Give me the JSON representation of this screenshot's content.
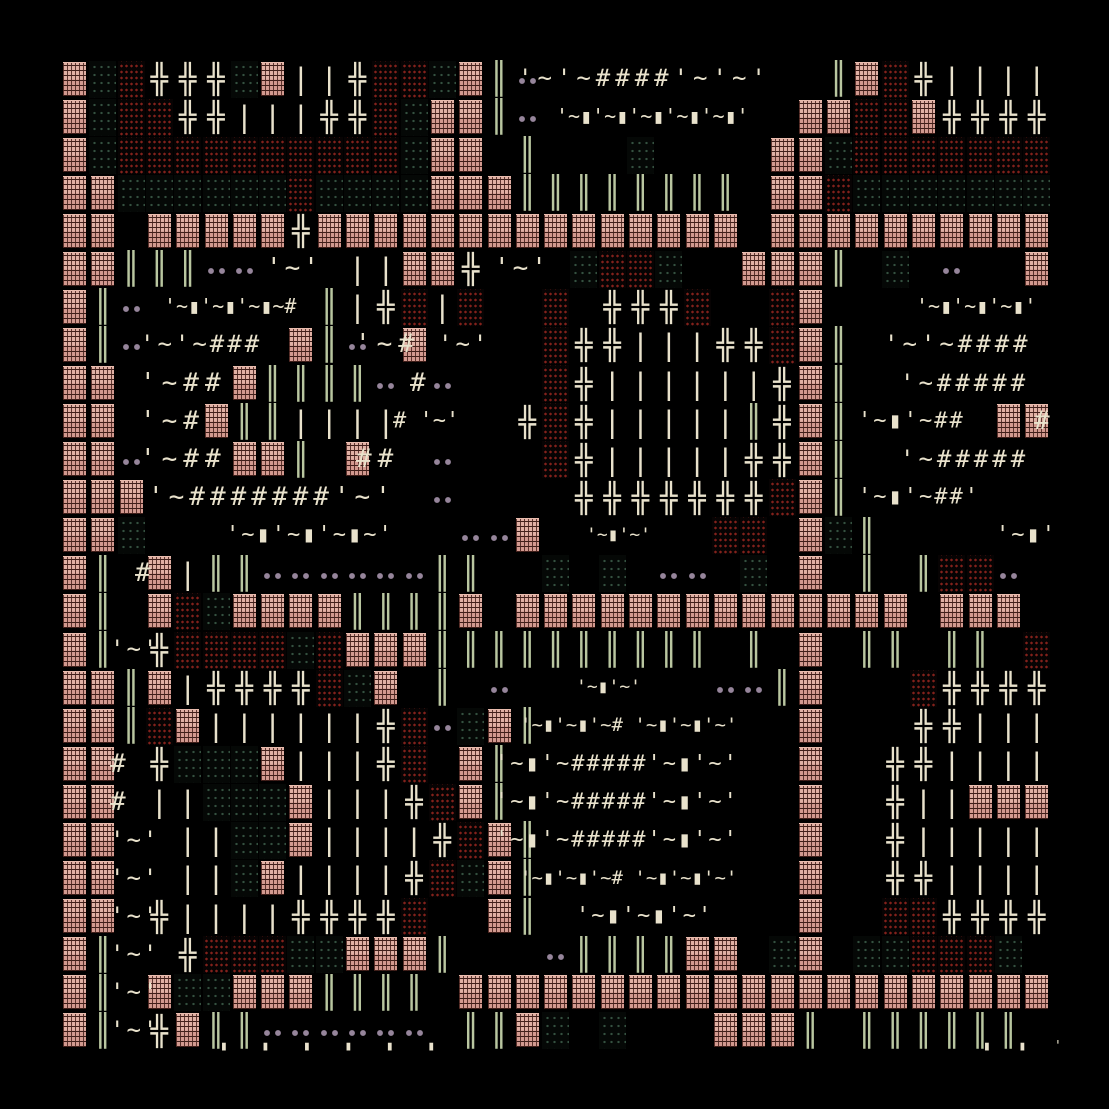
{
  "artwork": {
    "description": "generative ascii texture artwork on black background",
    "background": "#000000",
    "palette": {
      "cream_glyph": "#e9e2cc",
      "sage_double_bar": "#b9c6a0",
      "pink_block": "#d7a399",
      "pink_block_dark_seam": "#46201b",
      "pink_block_light_edge": "#e9bcae",
      "red_dot_block": "#83211b",
      "green_dot_block": "#355140",
      "mauve_dot": "#96859b"
    },
    "layout": {
      "art_x": 60,
      "art_y": 60,
      "cols": 35,
      "rows": 26,
      "cell_w": 28.3,
      "cell_h": 38.07
    }
  },
  "legend": {
    "P": {
      "name": "pink-woven-block",
      "type": "block",
      "cls": "bP"
    },
    "R": {
      "name": "red-dot-block",
      "type": "block",
      "cls": "bR"
    },
    "G": {
      "name": "green-dot-block",
      "type": "block",
      "cls": "bG"
    },
    ".": {
      "name": "mauve-dot-pair",
      "type": "block",
      "cls": "bD"
    },
    "+": {
      "name": "cross-glyph",
      "type": "glyph",
      "cls": "tC",
      "char": "╬"
    },
    "#": {
      "name": "hash-glyph",
      "type": "glyph",
      "cls": "tC",
      "char": "#"
    },
    "|": {
      "name": "bar-glyph",
      "type": "glyph",
      "cls": "tC",
      "char": "|"
    },
    "I": {
      "name": "double-bar-glyph",
      "type": "glyph",
      "cls": "tG",
      "char": "║"
    },
    "'": {
      "name": "apostrophe-glyph",
      "type": "glyph",
      "cls": "tC",
      "char": "'"
    },
    "~": {
      "name": "tilde-glyph",
      "type": "glyph",
      "cls": "tC",
      "char": "~"
    }
  },
  "grid": [
    "PGR+++GP||+RRGPI.          IPR+||||",
    "PGRR++|||++RGPPI.         PPRRP++++",
    "PGRRRRRRRRRRGPP I   G    PPGRRRRRRR",
    "PPGGGGGGRGGGGPPPIIIIIIII PPRGGGGGGG",
    "PP PPPPP+PPPPPPPPPPPPPPP PPPPPPPPPP",
    "PPIII..   ||PP+   GRRG  PPPI G .  P",
    "PI.      I|+R|R  R +++R  RP        ",
    "PI.     PI. P    R++|||++RPI       ",
    "PP    PIIII. .   R+||||||+PI       ",
    "PP   PII||||    +R+|||||I+PI     PP",
    "PP.   PPI P  .   R+|||||++PI       ",
    "PPP          .    +++++++RPI       ",
    "PPG           ..P      RR PGI      ",
    "PI P|II......II  G G .. G P I IRR. ",
    "PI PRGPPPPIIIIP PPPPPPPPPPPPPP PPP ",
    "PI +RRRRGRPPPIIIIIIIIII I P II II R",
    "PPIP|++++RGP I .       ..IP   R++++",
    "PPIRP||||||+R.GPI         P   ++|||",
    "PP +GGGP|||+R PI          P  ++||||",
    "PP ||GGGP|||+RPI          P  +||PPP",
    "PP  ||GGP||||+RPI         P  +|||||",
    "PP  ||GP||||+RGPI         P  ++||||",
    "PP +||||++++R  PI         P  RR++++",
    "PI  +RRRGGPPPI   .IIIIPP GP GGRRRG ",
    "PI PGGPPPIIII PPPPPPPPPPPPPPPPPPPPP",
    "PI +PII...... IIPG G   PPPI IIIIII "
  ],
  "texts": [
    {
      "x": 518,
      "y": 79,
      "s": 24,
      "ls": 5,
      "t": "'~'~####'~'~'"
    },
    {
      "x": 556,
      "y": 117,
      "s": 20,
      "ls": 0,
      "t": "'~▮'~▮'~▮'~▮'~▮'"
    },
    {
      "x": 266,
      "y": 269,
      "s": 26,
      "ls": 3,
      "t": "'~'"
    },
    {
      "x": 494,
      "y": 269,
      "s": 26,
      "ls": 3,
      "t": "'~'"
    },
    {
      "x": 164,
      "y": 307,
      "s": 20,
      "ls": 0,
      "t": "'~▮'~▮'~▮~#"
    },
    {
      "x": 916,
      "y": 307,
      "s": 20,
      "ls": 0,
      "t": "'~▮'~▮'~▮'"
    },
    {
      "x": 140,
      "y": 345,
      "s": 24,
      "ls": 3,
      "t": "'~'~###"
    },
    {
      "x": 355,
      "y": 345,
      "s": 26,
      "ls": 6,
      "t": "'~#"
    },
    {
      "x": 438,
      "y": 345,
      "s": 24,
      "ls": 3,
      "t": "'~'"
    },
    {
      "x": 884,
      "y": 345,
      "s": 24,
      "ls": 4,
      "t": "'~'~####"
    },
    {
      "x": 140,
      "y": 384,
      "s": 26,
      "ls": 6,
      "t": "'~##"
    },
    {
      "x": 410,
      "y": 384,
      "s": 26,
      "ls": 0,
      "t": "#"
    },
    {
      "x": 900,
      "y": 384,
      "s": 24,
      "ls": 4,
      "t": "'~#####"
    },
    {
      "x": 140,
      "y": 422,
      "s": 26,
      "ls": 6,
      "t": "'~#"
    },
    {
      "x": 393,
      "y": 422,
      "s": 22,
      "ls": 0,
      "t": "# '~'"
    },
    {
      "x": 858,
      "y": 422,
      "s": 22,
      "ls": 2,
      "t": "'~▮'~##"
    },
    {
      "x": 1034,
      "y": 422,
      "s": 26,
      "ls": 0,
      "t": "#"
    },
    {
      "x": 140,
      "y": 460,
      "s": 26,
      "ls": 6,
      "t": "'~##"
    },
    {
      "x": 356,
      "y": 460,
      "s": 26,
      "ls": 6,
      "t": "##"
    },
    {
      "x": 900,
      "y": 460,
      "s": 24,
      "ls": 4,
      "t": "'~#####"
    },
    {
      "x": 148,
      "y": 498,
      "s": 26,
      "ls": 5,
      "t": "'~#######'~'"
    },
    {
      "x": 858,
      "y": 498,
      "s": 22,
      "ls": 2,
      "t": "'~▮'~##'"
    },
    {
      "x": 226,
      "y": 536,
      "s": 22,
      "ls": 2,
      "t": "'~▮'~▮'~▮~'"
    },
    {
      "x": 586,
      "y": 536,
      "s": 18,
      "ls": 0,
      "t": "'~▮'~'"
    },
    {
      "x": 996,
      "y": 536,
      "s": 22,
      "ls": 2,
      "t": "'~▮'"
    },
    {
      "x": 135,
      "y": 574,
      "s": 26,
      "ls": 0,
      "t": "#"
    },
    {
      "x": 110,
      "y": 650,
      "s": 24,
      "ls": 2,
      "t": "'~'"
    },
    {
      "x": 576,
      "y": 688,
      "s": 18,
      "ls": 0,
      "t": "'~▮'~'"
    },
    {
      "x": 520,
      "y": 726,
      "s": 19,
      "ls": 0,
      "t": "'~▮'~▮'~# '~▮'~▮'~'"
    },
    {
      "x": 110,
      "y": 765,
      "s": 26,
      "ls": 0,
      "t": "#"
    },
    {
      "x": 495,
      "y": 765,
      "s": 22,
      "ls": 2,
      "t": "'~▮'~#####'~▮'~'"
    },
    {
      "x": 110,
      "y": 803,
      "s": 26,
      "ls": 0,
      "t": "#"
    },
    {
      "x": 495,
      "y": 803,
      "s": 22,
      "ls": 2,
      "t": "'~▮'~#####'~▮'~'"
    },
    {
      "x": 110,
      "y": 841,
      "s": 24,
      "ls": 2,
      "t": "'~'"
    },
    {
      "x": 495,
      "y": 841,
      "s": 22,
      "ls": 2,
      "t": "'~▮'~#####'~▮'~'"
    },
    {
      "x": 110,
      "y": 879,
      "s": 24,
      "ls": 2,
      "t": "'~'"
    },
    {
      "x": 520,
      "y": 879,
      "s": 19,
      "ls": 0,
      "t": "'~▮'~▮'~# '~▮'~▮'~'"
    },
    {
      "x": 110,
      "y": 917,
      "s": 24,
      "ls": 2,
      "t": "'~'"
    },
    {
      "x": 576,
      "y": 917,
      "s": 22,
      "ls": 2,
      "t": "'~▮'~▮'~'"
    },
    {
      "x": 110,
      "y": 955,
      "s": 24,
      "ls": 2,
      "t": "'~'"
    },
    {
      "x": 110,
      "y": 993,
      "s": 24,
      "ls": 2,
      "t": "'~'"
    },
    {
      "x": 110,
      "y": 1031,
      "s": 24,
      "ls": 2,
      "t": "'~'"
    },
    {
      "x": 220,
      "y": 1047,
      "s": 13,
      "ls": 6,
      "t": "▮  ▮  ▮  ▮  ▮  ▮"
    },
    {
      "x": 983,
      "y": 1047,
      "s": 13,
      "ls": 4,
      "t": "▮  ▮  '"
    }
  ]
}
